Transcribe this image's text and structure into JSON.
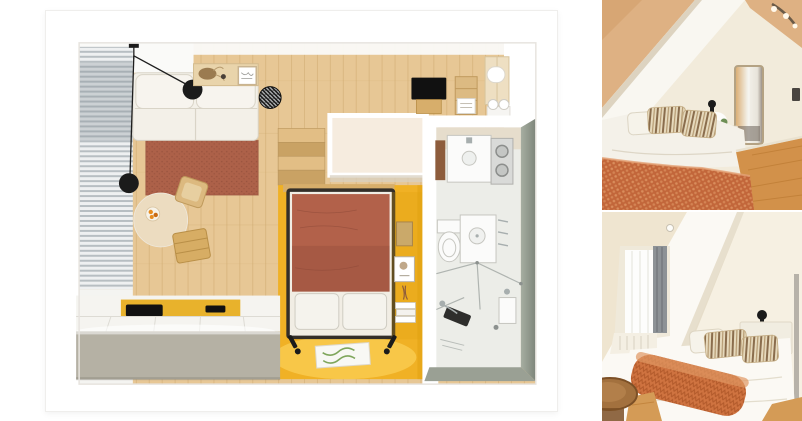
{
  "collage": {
    "description": "interior-collage",
    "left_panel": "studio-floor-plan-render",
    "right_panels": [
      "attic-bedroom-photo-top",
      "attic-bedroom-photo-bottom"
    ]
  },
  "floorplan": {
    "rooms": [
      "living-area",
      "kitchen",
      "sleeping-alcove",
      "hallway",
      "bathroom"
    ],
    "objects": [
      "corner-sofa",
      "terracotta-rug",
      "pendant-lamps",
      "window-blinds",
      "wall-shelf",
      "striped-pouf",
      "round-dining-table",
      "fruit-bowl",
      "dining-stool",
      "dining-chair",
      "wooden-stairs",
      "wardrobe-block",
      "double-bed",
      "pillows",
      "niche-shelving",
      "reading-lamps",
      "green-mat",
      "kitchen-counter",
      "cooktop",
      "sink",
      "tv",
      "media-shelf",
      "hall-wardrobe",
      "towel-rolls",
      "vanity",
      "washer-dryer",
      "toilet",
      "washbasin",
      "shower"
    ]
  },
  "photo_top": {
    "objects": [
      "sloped-ceiling",
      "tan-attic-ceiling",
      "ceiling-spotlights",
      "wall-mirror",
      "wall-lamp",
      "bedside-table",
      "bed-with-striped-pillows",
      "orange-checkered-blanket",
      "wood-floor",
      "wall-switch"
    ]
  },
  "photo_bottom": {
    "objects": [
      "sloped-ceiling",
      "dormer-window",
      "gray-curtain",
      "window-sill",
      "ceiling-spotlight",
      "bed-with-striped-pillows",
      "orange-knit-throw",
      "headboard",
      "wall-lamp",
      "plant-side-table",
      "mirror-rail",
      "wooden-stool",
      "wood-floor"
    ]
  },
  "palette": {
    "page_bg": "#ffffff",
    "card_edge": "#efeeec",
    "wall_white": "#ffffff",
    "interior_line": "#e7e4df",
    "ceiling_white": "#fafaf8",
    "floor_wood": "#e7c795",
    "floor_plank": "#c9a468",
    "wood_mid": "#d7ae6b",
    "curtain_light": "#eef0f1",
    "curtain_dark": "#b7bec2",
    "sofa": "#f3f0e8",
    "sofa_line": "#d9d4c7",
    "rug": "#ad6149",
    "rug_dark": "#94503c",
    "lamp_black": "#1b1b1b",
    "table_cream": "#ecdcc0",
    "fruit": "#e78b1d",
    "stairs_light": "#e2be85",
    "stairs_dark": "#c9a264",
    "block_cream": "#f6ecdf",
    "yellow": "#f0b125",
    "yellow_deep": "#dfa00f",
    "yellow_light": "#ffd866",
    "bed_frame": "#332e28",
    "duvet": "#b2614a",
    "duvet_dark": "#9c5340",
    "pillow": "#f5f3ed",
    "pillow_line": "#cfccc2",
    "mat_green": "#7fa65c",
    "tv_black": "#111111",
    "shelf_wood": "#dcba82",
    "wardrobe": "#eedfc2",
    "bath_floor": "#ecede8",
    "bath_beige": "#e6ddcc",
    "bath_wall": "#8e968b",
    "fixture": "#fbfbfa",
    "fixture_line": "#c6c6c0",
    "chrome": "#a7aeae",
    "steel": "#d9dad8",
    "brown_mat": "#8d5c3c",
    "counter_face": "#b5b1a4",
    "counter_top": "#f5f4f0",
    "counter_seam": "#dddbd4",
    "p1_wall": "#f2ebdb",
    "p1_tan": "#deb183",
    "p1_tan_dark": "#cf9c66",
    "p1_slope": "#f9f7f1",
    "p1_slope_shadow": "#ddd3c0",
    "p1_blanket": "#c2663a",
    "p1_blanket_light": "#d98d5c",
    "p1_duvet": "#f4f1e9",
    "p1_floor": "#d2914a",
    "p1_floor_line": "#b9772f",
    "p1_mirror_frame": "#b4a283",
    "pillow_stripe_bg": "#e6d9bc",
    "pillow_stripe": "#8a6d4d",
    "p2_wall": "#f6f0e2",
    "p2_slope": "#fbf9f4",
    "p2_shadow": "#e2d8c3",
    "p2_curtain": "#8d9296",
    "p2_curtain_dark": "#70757a",
    "p2_window": "#fdfdfc",
    "p2_throw": "#cf7340",
    "p2_throw_dark": "#b25a2b",
    "p2_floor": "#d49b56",
    "p2_stool": "#a3713e",
    "p2_stool_dark": "#7c5026",
    "p2_plant": "#6e8f56",
    "p2_rail": "#b7b2a9"
  }
}
